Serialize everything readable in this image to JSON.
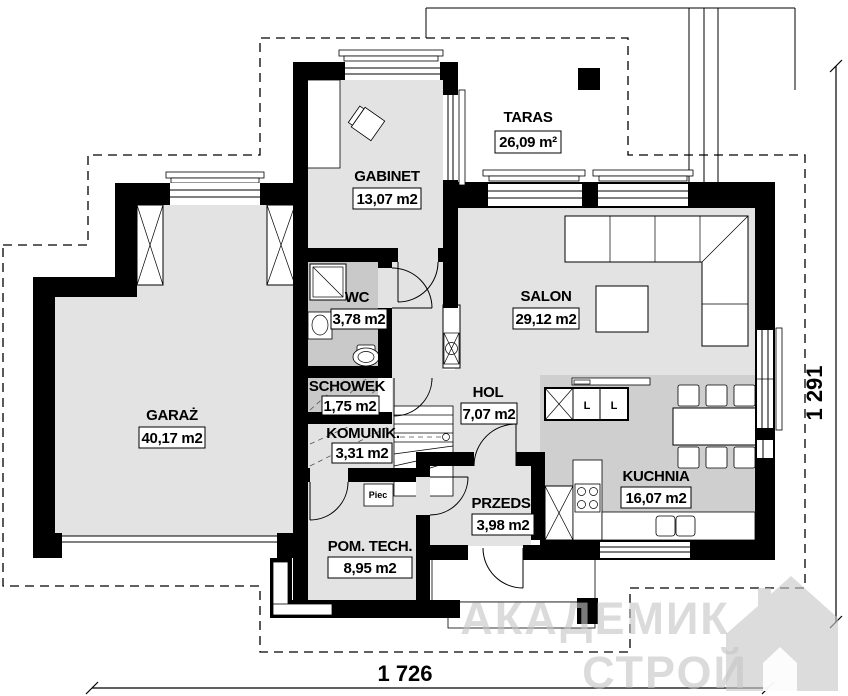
{
  "plan": {
    "rooms": [
      {
        "id": "taras",
        "name": "TARAS",
        "area": "26,09 m²"
      },
      {
        "id": "gabinet",
        "name": "GABINET",
        "area": "13,07 m2"
      },
      {
        "id": "salon",
        "name": "SALON",
        "area": "29,12 m2"
      },
      {
        "id": "wc",
        "name": "WC",
        "area": "3,78 m2"
      },
      {
        "id": "garaz",
        "name": "GARAŻ",
        "area": "40,17 m2"
      },
      {
        "id": "schowek",
        "name": "SCHOWEK",
        "area": "1,75 m2"
      },
      {
        "id": "komunik",
        "name": "KOMUNIK.",
        "area": "3,31 m2"
      },
      {
        "id": "hol",
        "name": "HOL",
        "area": "7,07 m2"
      },
      {
        "id": "przeds",
        "name": "PRZEDS.",
        "area": "3,98 m2"
      },
      {
        "id": "kuchnia",
        "name": "KUCHNIA",
        "area": "16,07 m2"
      },
      {
        "id": "pom_tech",
        "name": "POM. TECH.",
        "area": "8,95 m2"
      }
    ],
    "annotations": {
      "furnace": "Piec",
      "island_unit_1": "L",
      "island_unit_2": "L"
    },
    "dimensions": {
      "width": "1 726",
      "height": "1 291"
    },
    "watermark": {
      "line1": "АКАДЕМИК",
      "line2": "СТРОЙ"
    },
    "colors": {
      "wall": "#000000",
      "floor": "#e3e3e3",
      "floor_dark": "#c9c9c9",
      "kitchen_floor": "#cfcfcf",
      "watermark": "#c6c6c6"
    }
  }
}
